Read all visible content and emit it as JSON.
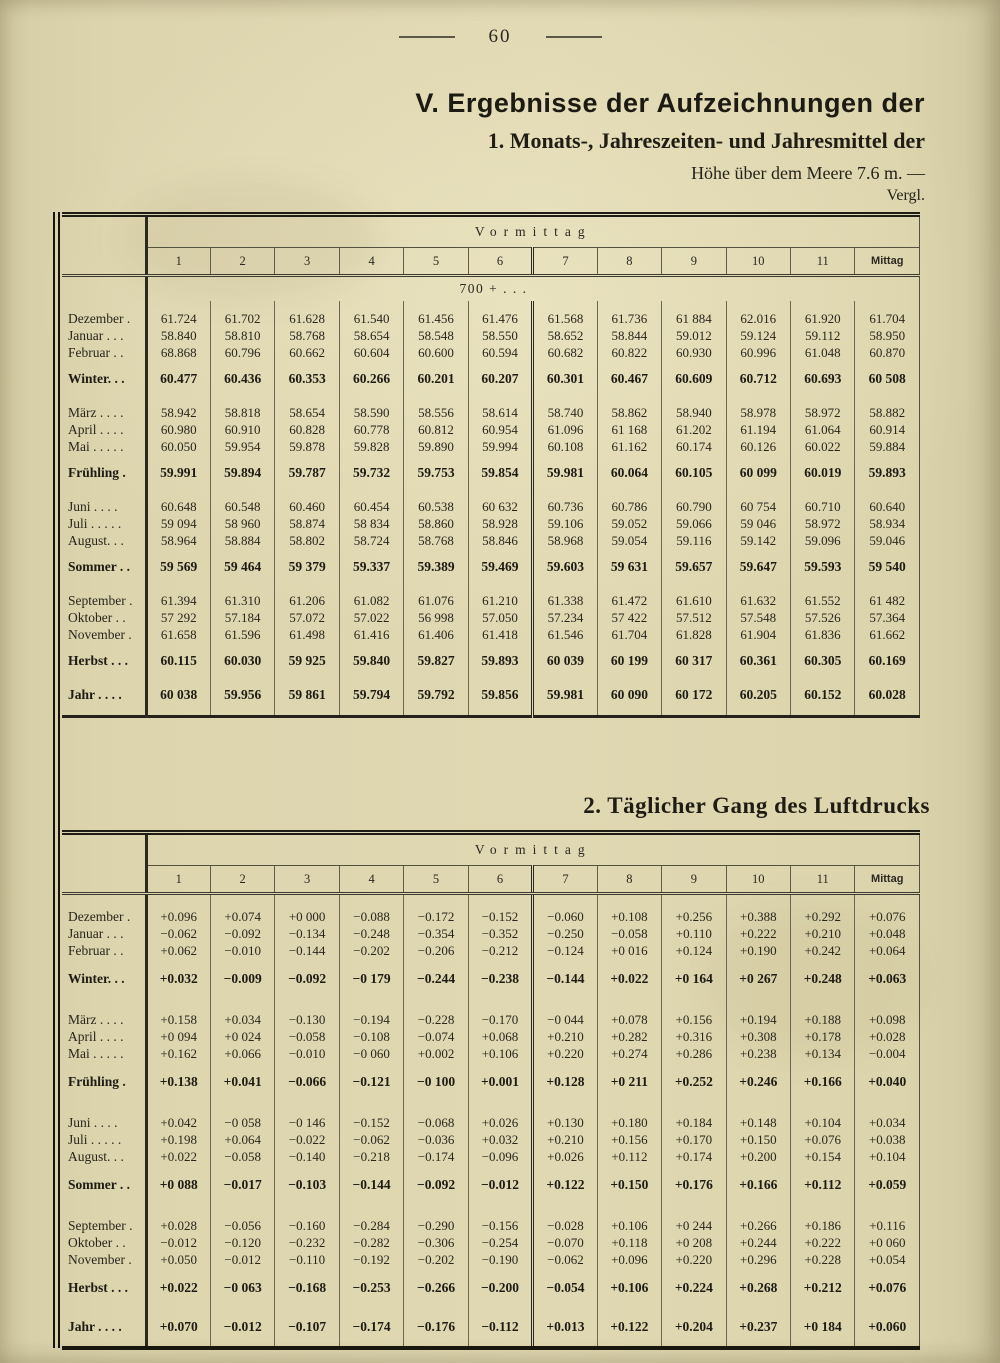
{
  "page": {
    "number": "60"
  },
  "header": {
    "title": "V. Ergebnisse der Aufzeichnungen der",
    "subtitle": "1. Monats-, Jahreszeiten- und Jahresmittel der",
    "height_note": "Höhe über dem Meere 7.6 m. —",
    "compare_note": "Vergl."
  },
  "section2": {
    "title": "2. Täglicher Gang des Luftdrucks"
  },
  "table1": {
    "name": "monthly-means-table",
    "group_header": "Vormittag",
    "columns": [
      "1",
      "2",
      "3",
      "4",
      "5",
      "6",
      "7",
      "8",
      "9",
      "10",
      "11",
      "Mittag"
    ],
    "note": "700 + . . .",
    "groups": [
      {
        "rows": [
          {
            "label": "Dezember .",
            "bold": false,
            "values": [
              "61.724",
              "61.702",
              "61.628",
              "61.540",
              "61.456",
              "61.476",
              "61.568",
              "61.736",
              "61 884",
              "62.016",
              "61.920",
              "61.704"
            ]
          },
          {
            "label": "Januar . . .",
            "bold": false,
            "values": [
              "58.840",
              "58.810",
              "58.768",
              "58.654",
              "58.548",
              "58.550",
              "58.652",
              "58.844",
              "59.012",
              "59.124",
              "59.112",
              "58.950"
            ]
          },
          {
            "label": "Februar . .",
            "bold": false,
            "values": [
              "68.868",
              "60.796",
              "60.662",
              "60.604",
              "60.600",
              "60.594",
              "60.682",
              "60.822",
              "60.930",
              "60.996",
              "61.048",
              "60.870"
            ]
          },
          {
            "label": "Winter. . .",
            "bold": true,
            "values": [
              "60.477",
              "60.436",
              "60.353",
              "60.266",
              "60.201",
              "60.207",
              "60.301",
              "60.467",
              "60.609",
              "60.712",
              "60.693",
              "60 508"
            ]
          }
        ]
      },
      {
        "rows": [
          {
            "label": "März . . . .",
            "bold": false,
            "values": [
              "58.942",
              "58.818",
              "58.654",
              "58.590",
              "58.556",
              "58.614",
              "58.740",
              "58.862",
              "58.940",
              "58.978",
              "58.972",
              "58.882"
            ]
          },
          {
            "label": "April . . . .",
            "bold": false,
            "values": [
              "60.980",
              "60.910",
              "60.828",
              "60.778",
              "60.812",
              "60.954",
              "61.096",
              "61 168",
              "61.202",
              "61.194",
              "61.064",
              "60.914"
            ]
          },
          {
            "label": "Mai . . . . .",
            "bold": false,
            "values": [
              "60.050",
              "59.954",
              "59.878",
              "59.828",
              "59.890",
              "59.994",
              "60.108",
              "61.162",
              "60.174",
              "60.126",
              "60.022",
              "59.884"
            ]
          },
          {
            "label": "Frühling .",
            "bold": true,
            "values": [
              "59.991",
              "59.894",
              "59.787",
              "59.732",
              "59.753",
              "59.854",
              "59.981",
              "60.064",
              "60.105",
              "60 099",
              "60.019",
              "59.893"
            ]
          }
        ]
      },
      {
        "rows": [
          {
            "label": "Juni . . . .",
            "bold": false,
            "values": [
              "60.648",
              "60.548",
              "60.460",
              "60.454",
              "60.538",
              "60 632",
              "60.736",
              "60.786",
              "60.790",
              "60 754",
              "60.710",
              "60.640"
            ]
          },
          {
            "label": "Juli . . . . .",
            "bold": false,
            "values": [
              "59 094",
              "58 960",
              "58.874",
              "58 834",
              "58.860",
              "58.928",
              "59.106",
              "59.052",
              "59.066",
              "59 046",
              "58.972",
              "58.934"
            ]
          },
          {
            "label": "August. . .",
            "bold": false,
            "values": [
              "58.964",
              "58.884",
              "58.802",
              "58.724",
              "58.768",
              "58.846",
              "58.968",
              "59.054",
              "59.116",
              "59.142",
              "59.096",
              "59.046"
            ]
          },
          {
            "label": "Sommer . .",
            "bold": true,
            "values": [
              "59 569",
              "59 464",
              "59 379",
              "59.337",
              "59.389",
              "59.469",
              "59.603",
              "59 631",
              "59.657",
              "59.647",
              "59.593",
              "59 540"
            ]
          }
        ]
      },
      {
        "rows": [
          {
            "label": "September .",
            "bold": false,
            "values": [
              "61.394",
              "61.310",
              "61.206",
              "61.082",
              "61.076",
              "61.210",
              "61.338",
              "61.472",
              "61.610",
              "61.632",
              "61.552",
              "61 482"
            ]
          },
          {
            "label": "Oktober . .",
            "bold": false,
            "values": [
              "57 292",
              "57.184",
              "57.072",
              "57.022",
              "56 998",
              "57.050",
              "57.234",
              "57 422",
              "57.512",
              "57.548",
              "57.526",
              "57.364"
            ]
          },
          {
            "label": "November .",
            "bold": false,
            "values": [
              "61.658",
              "61.596",
              "61.498",
              "61.416",
              "61.406",
              "61.418",
              "61.546",
              "61.704",
              "61.828",
              "61.904",
              "61.836",
              "61.662"
            ]
          },
          {
            "label": "Herbst . . .",
            "bold": true,
            "values": [
              "60.115",
              "60.030",
              "59 925",
              "59.840",
              "59.827",
              "59.893",
              "60 039",
              "60 199",
              "60 317",
              "60.361",
              "60.305",
              "60.169"
            ]
          }
        ]
      },
      {
        "rows": [
          {
            "label": "Jahr . . . .",
            "bold": true,
            "values": [
              "60 038",
              "59.956",
              "59 861",
              "59.794",
              "59.792",
              "59.856",
              "59.981",
              "60 090",
              "60 172",
              "60.205",
              "60.152",
              "60.028"
            ]
          }
        ]
      }
    ]
  },
  "table2": {
    "name": "daily-course-table",
    "group_header": "Vormittag",
    "columns": [
      "1",
      "2",
      "3",
      "4",
      "5",
      "6",
      "7",
      "8",
      "9",
      "10",
      "11",
      "Mittag"
    ],
    "note": "",
    "groups": [
      {
        "rows": [
          {
            "label": "Dezember .",
            "bold": false,
            "values": [
              "+0.096",
              "+0.074",
              "+0 000",
              "−0.088",
              "−0.172",
              "−0.152",
              "−0.060",
              "+0.108",
              "+0.256",
              "+0.388",
              "+0.292",
              "+0.076"
            ]
          },
          {
            "label": "Januar . . .",
            "bold": false,
            "values": [
              "−0.062",
              "−0.092",
              "−0.134",
              "−0.248",
              "−0.354",
              "−0.352",
              "−0.250",
              "−0.058",
              "+0.110",
              "+0.222",
              "+0.210",
              "+0.048"
            ]
          },
          {
            "label": "Februar . .",
            "bold": false,
            "values": [
              "+0.062",
              "−0.010",
              "−0.144",
              "−0.202",
              "−0.206",
              "−0.212",
              "−0.124",
              "+0 016",
              "+0.124",
              "+0.190",
              "+0.242",
              "+0.064"
            ]
          },
          {
            "label": "Winter. . .",
            "bold": true,
            "values": [
              "+0.032",
              "−0.009",
              "−0.092",
              "−0 179",
              "−0.244",
              "−0.238",
              "−0.144",
              "+0.022",
              "+0 164",
              "+0 267",
              "+0.248",
              "+0.063"
            ]
          }
        ]
      },
      {
        "rows": [
          {
            "label": "März . . . .",
            "bold": false,
            "values": [
              "+0.158",
              "+0.034",
              "−0.130",
              "−0.194",
              "−0.228",
              "−0.170",
              "−0 044",
              "+0.078",
              "+0.156",
              "+0.194",
              "+0.188",
              "+0.098"
            ]
          },
          {
            "label": "April . . . .",
            "bold": false,
            "values": [
              "+0 094",
              "+0 024",
              "−0.058",
              "−0.108",
              "−0.074",
              "+0.068",
              "+0.210",
              "+0.282",
              "+0.316",
              "+0.308",
              "+0.178",
              "+0.028"
            ]
          },
          {
            "label": "Mai . . . . .",
            "bold": false,
            "values": [
              "+0.162",
              "+0.066",
              "−0.010",
              "−0 060",
              "+0.002",
              "+0.106",
              "+0.220",
              "+0.274",
              "+0.286",
              "+0.238",
              "+0.134",
              "−0.004"
            ]
          },
          {
            "label": "Frühling .",
            "bold": true,
            "values": [
              "+0.138",
              "+0.041",
              "−0.066",
              "−0.121",
              "−0 100",
              "+0.001",
              "+0.128",
              "+0 211",
              "+0.252",
              "+0.246",
              "+0.166",
              "+0.040"
            ]
          }
        ]
      },
      {
        "rows": [
          {
            "label": "Juni . . . .",
            "bold": false,
            "values": [
              "+0.042",
              "−0 058",
              "−0 146",
              "−0.152",
              "−0.068",
              "+0.026",
              "+0.130",
              "+0.180",
              "+0.184",
              "+0.148",
              "+0.104",
              "+0.034"
            ]
          },
          {
            "label": "Juli . . . . .",
            "bold": false,
            "values": [
              "+0.198",
              "+0.064",
              "−0.022",
              "−0.062",
              "−0.036",
              "+0.032",
              "+0.210",
              "+0.156",
              "+0.170",
              "+0.150",
              "+0.076",
              "+0.038"
            ]
          },
          {
            "label": "August. . .",
            "bold": false,
            "values": [
              "+0.022",
              "−0.058",
              "−0.140",
              "−0.218",
              "−0.174",
              "−0.096",
              "+0.026",
              "+0.112",
              "+0.174",
              "+0.200",
              "+0.154",
              "+0.104"
            ]
          },
          {
            "label": "Sommer . .",
            "bold": true,
            "values": [
              "+0 088",
              "−0.017",
              "−0.103",
              "−0.144",
              "−0.092",
              "−0.012",
              "+0.122",
              "+0.150",
              "+0.176",
              "+0.166",
              "+0.112",
              "+0.059"
            ]
          }
        ]
      },
      {
        "rows": [
          {
            "label": "September .",
            "bold": false,
            "values": [
              "+0.028",
              "−0.056",
              "−0.160",
              "−0.284",
              "−0.290",
              "−0.156",
              "−0.028",
              "+0.106",
              "+0 244",
              "+0.266",
              "+0.186",
              "+0.116"
            ]
          },
          {
            "label": "Oktober . .",
            "bold": false,
            "values": [
              "−0.012",
              "−0.120",
              "−0.232",
              "−0.282",
              "−0.306",
              "−0.254",
              "−0.070",
              "+0.118",
              "+0 208",
              "+0.244",
              "+0.222",
              "+0 060"
            ]
          },
          {
            "label": "November .",
            "bold": false,
            "values": [
              "+0.050",
              "−0.012",
              "−0.110",
              "−0.192",
              "−0.202",
              "−0.190",
              "−0.062",
              "+0.096",
              "+0.220",
              "+0.296",
              "+0.228",
              "+0.054"
            ]
          },
          {
            "label": "Herbst . . .",
            "bold": true,
            "values": [
              "+0.022",
              "−0 063",
              "−0.168",
              "−0.253",
              "−0.266",
              "−0.200",
              "−0.054",
              "+0.106",
              "+0.224",
              "+0.268",
              "+0.212",
              "+0.076"
            ]
          }
        ]
      },
      {
        "rows": [
          {
            "label": "Jahr . . . .",
            "bold": true,
            "values": [
              "+0.070",
              "−0.012",
              "−0.107",
              "−0.174",
              "−0.176",
              "−0.112",
              "+0.013",
              "+0.122",
              "+0.204",
              "+0.237",
              "+0 184",
              "+0.060"
            ]
          }
        ]
      }
    ]
  }
}
